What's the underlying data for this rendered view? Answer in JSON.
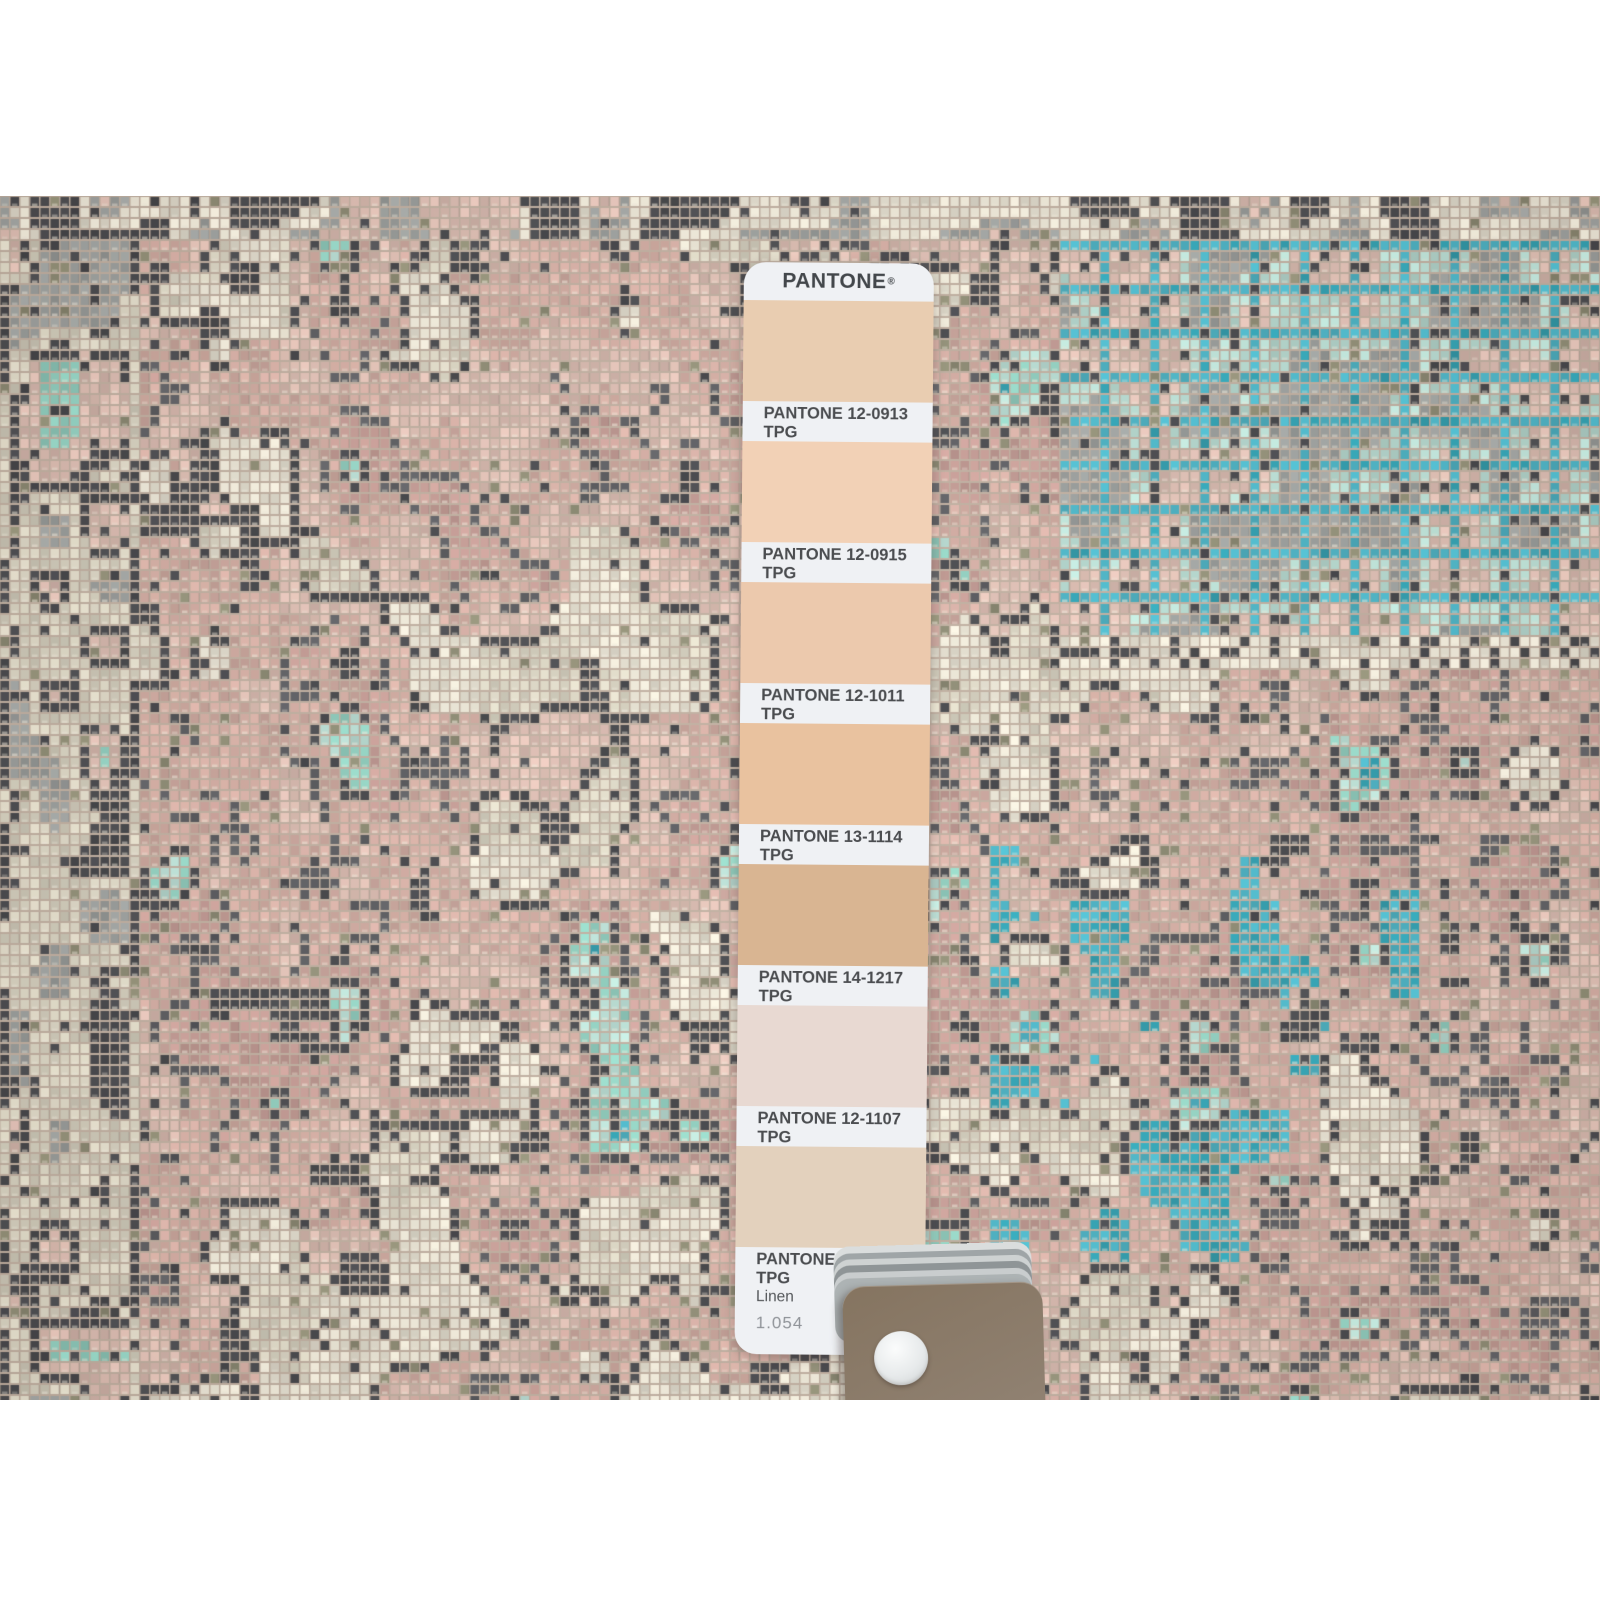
{
  "photo": {
    "description": "Overhead close-up photograph of a distressed vintage Persian-style rug in washed pink, ivory, teal and charcoal, photographed with a PANTONE TPG fan-guide color strip and the guide's brown cover card resting on top of the pile"
  },
  "pantone_strip": {
    "brand": "PANTONE",
    "registered": "®",
    "page_number": "1.054",
    "swatches": [
      {
        "code": "PANTONE 12-0913 TPG",
        "name": "Alesan",
        "hex": "#e9cdb1"
      },
      {
        "code": "PANTONE 12-0915 TPG",
        "name": "Pale Peach",
        "hex": "#f2d1b6"
      },
      {
        "code": "PANTONE 12-1011 TPG",
        "name": "Peach Purée",
        "hex": "#ecc9ad"
      },
      {
        "code": "PANTONE 13-1114 TPG",
        "name": "Bellini",
        "hex": "#e9c29f"
      },
      {
        "code": "PANTONE 14-1217 TPG",
        "name": "Amberlight",
        "hex": "#d9b592"
      },
      {
        "code": "PANTONE 12-1107 TPG",
        "name": "Peach Dust",
        "hex": "#e8d9d2"
      },
      {
        "code": "PANTONE 12-1008 TPG",
        "name": "Linen",
        "hex": "#e3d1bd"
      }
    ]
  },
  "guide_stack": {
    "cover_color": "#8c7c68",
    "rivet_color": "#eef0f1",
    "page_edge_colors": [
      "#dadddd",
      "#9fa5a7",
      "#ced2d2",
      "#8f9597",
      "#c9cdce",
      "#adb3b4"
    ]
  },
  "rug": {
    "palette": {
      "pink1": "#d2aba1",
      "pink2": "#c69c95",
      "pink3": "#dcbcb1",
      "blush": "#e3cabc",
      "ivory": "#e7e2d2",
      "ivory2": "#d8d3c1",
      "teal": "#49b4c6",
      "teal2": "#2d9fb0",
      "mint": "#8fcfbf",
      "aqua": "#b8ddd3",
      "charcoal": "#45464a",
      "char2": "#5a5b5f",
      "gray": "#9a9e9c",
      "olive": "#8c8a72",
      "backing": "#bfae9f"
    }
  }
}
